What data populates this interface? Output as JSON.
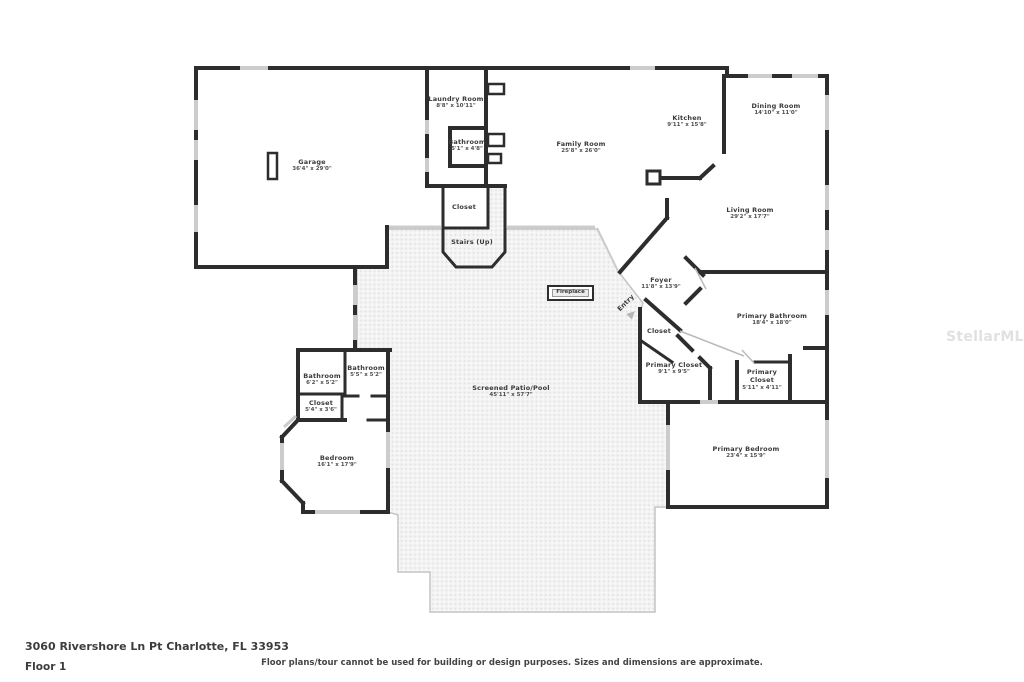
{
  "page": {
    "address": "3060 Rivershore Ln Pt Charlotte, FL 33953",
    "floor_label": "Floor 1",
    "disclaimer": "Floor plans/tour cannot be used for building or design purposes. Sizes and dimensions are approximate.",
    "watermark": "StellarMLS"
  },
  "rooms": {
    "garage": {
      "name": "Garage",
      "dims": "36'4\" x 29'0\""
    },
    "laundry": {
      "name": "Laundry Room",
      "dims": "8'8\" x 10'11\""
    },
    "bathroom_hall": {
      "name": "Bathroom",
      "dims": "5'1\" x 4'8\""
    },
    "family": {
      "name": "Family Room",
      "dims": "25'8\" x 26'0\""
    },
    "kitchen": {
      "name": "Kitchen",
      "dims": "9'11\" x 15'8\""
    },
    "dining": {
      "name": "Dining Room",
      "dims": "14'10\" x 11'0\""
    },
    "living": {
      "name": "Living Room",
      "dims": "29'2\" x 17'7\""
    },
    "stairs_closet": {
      "name": "Closet"
    },
    "stairs": {
      "name": "Stairs (Up)"
    },
    "fireplace": {
      "name": "Fireplace"
    },
    "foyer": {
      "name": "Foyer",
      "dims": "11'8\" x 13'9\""
    },
    "entry": {
      "name": "Entry"
    },
    "foyer_closet": {
      "name": "Closet"
    },
    "primary_bathroom": {
      "name": "Primary Bathroom",
      "dims": "18'4\" x 18'0\""
    },
    "primary_closet": {
      "name": "Primary Closet",
      "dims": "9'1\" x 9'5\""
    },
    "primary_closet_2": {
      "name_line1": "Primary",
      "name_line2": "Closet",
      "dims": "5'11\" x 4'11\""
    },
    "bathroom_left": {
      "name": "Bathroom",
      "dims": "6'2\" x 5'2\""
    },
    "bathroom_right": {
      "name": "Bathroom",
      "dims": "5'5\" x 5'2\""
    },
    "bedroom_closet": {
      "name": "Closet",
      "dims": "5'4\" x 3'6\""
    },
    "bedroom": {
      "name": "Bedroom",
      "dims": "16'1\" x 17'9\""
    },
    "patio": {
      "name": "Screened Patio/Pool",
      "dims": "45'11\" x 57'7\""
    },
    "primary_bedroom": {
      "name": "Primary Bedroom",
      "dims": "23'4\" x 15'9\""
    }
  }
}
